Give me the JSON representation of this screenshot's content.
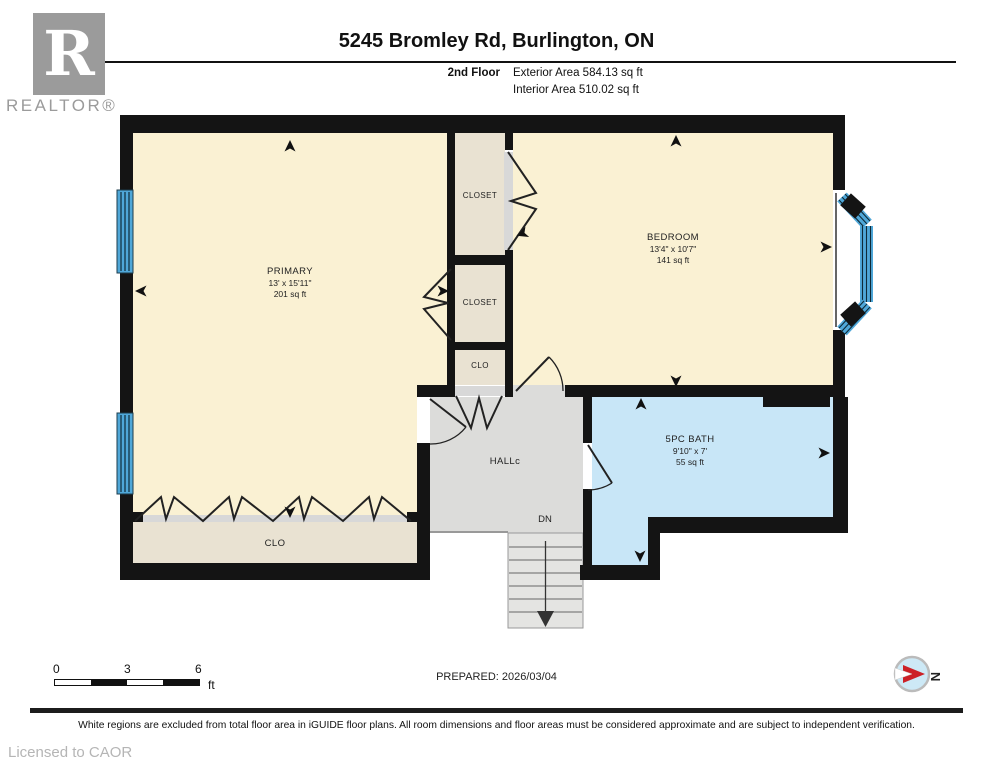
{
  "header": {
    "logo_letter": "R",
    "logo_text": "REALTOR®",
    "title": "5245 Bromley Rd, Burlington, ON",
    "floor_label": "2nd Floor",
    "exterior_area": "Exterior Area 584.13 sq ft",
    "interior_area": "Interior Area 510.02 sq ft"
  },
  "plan": {
    "rooms": {
      "primary": {
        "name": "PRIMARY",
        "dims": "13' x 15'11\"",
        "area": "201 sq ft"
      },
      "bedroom": {
        "name": "BEDROOM",
        "dims": "13'4\" x 10'7\"",
        "area": "141 sq ft"
      },
      "bath": {
        "name": "5PC BATH",
        "dims": "9'10\" x 7'",
        "area": "55 sq ft"
      },
      "closet_upper": {
        "name": "CLOSET"
      },
      "closet_lower": {
        "name": "CLOSET"
      },
      "clo_mid": {
        "name": "CLO"
      },
      "clo_bottom": {
        "name": "CLO"
      },
      "hall": {
        "name": "HALLc"
      },
      "stairs": {
        "label": "DN"
      }
    },
    "colors": {
      "wall": "#141414",
      "room_cream": "#faf1d3",
      "closet_beige": "#e9e2d2",
      "hall_grey": "#dcdcda",
      "stairs_grey": "#e4e4e2",
      "bath_blue": "#c8e6f7",
      "window_blue": "#4fa7d8",
      "compass_red": "#cc2127"
    }
  },
  "footer": {
    "scale": {
      "tick_0": "0",
      "tick_3": "3",
      "tick_6": "6",
      "unit": "ft"
    },
    "prepared": "PREPARED: 2026/03/04",
    "compass_letter": "N",
    "disclaimer": "White regions are excluded from total floor area in iGUIDE floor plans. All room dimensions and floor areas must be considered approximate and are subject to independent verification.",
    "licensed": "Licensed to CAOR"
  }
}
